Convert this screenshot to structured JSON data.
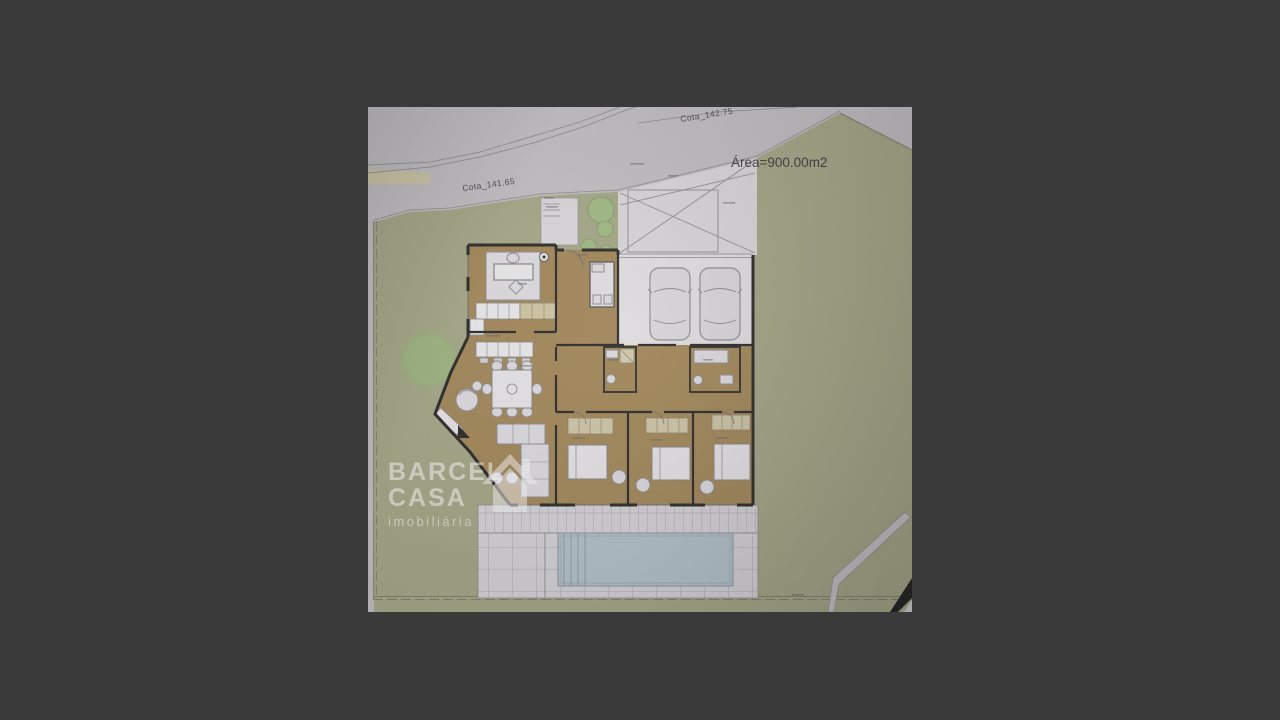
{
  "scene": {
    "background_color": "#3a3a3a"
  },
  "photo": {
    "description_labels": {
      "area_label": "Área=900.00m2",
      "contour_label_lower": "Cota_141.65",
      "contour_label_upper": "Cota_142.75"
    },
    "watermark": {
      "line1": "BARCEL",
      "line2": "CASA",
      "line3": "imobiliária",
      "icon": "house-icon"
    },
    "colors": {
      "bg": "#3a3a3a",
      "lawn": "#a9ac85",
      "road": "#c6c4c7",
      "floor": "#aa8a54",
      "white_room": "#e7e5e9",
      "walls": "#2d2b28",
      "pool": "#b6c9d2",
      "deck": "#dcdade",
      "tree": "#a3bf80",
      "wardrobe": "#d6cba6",
      "line": "#8f8d90"
    }
  }
}
